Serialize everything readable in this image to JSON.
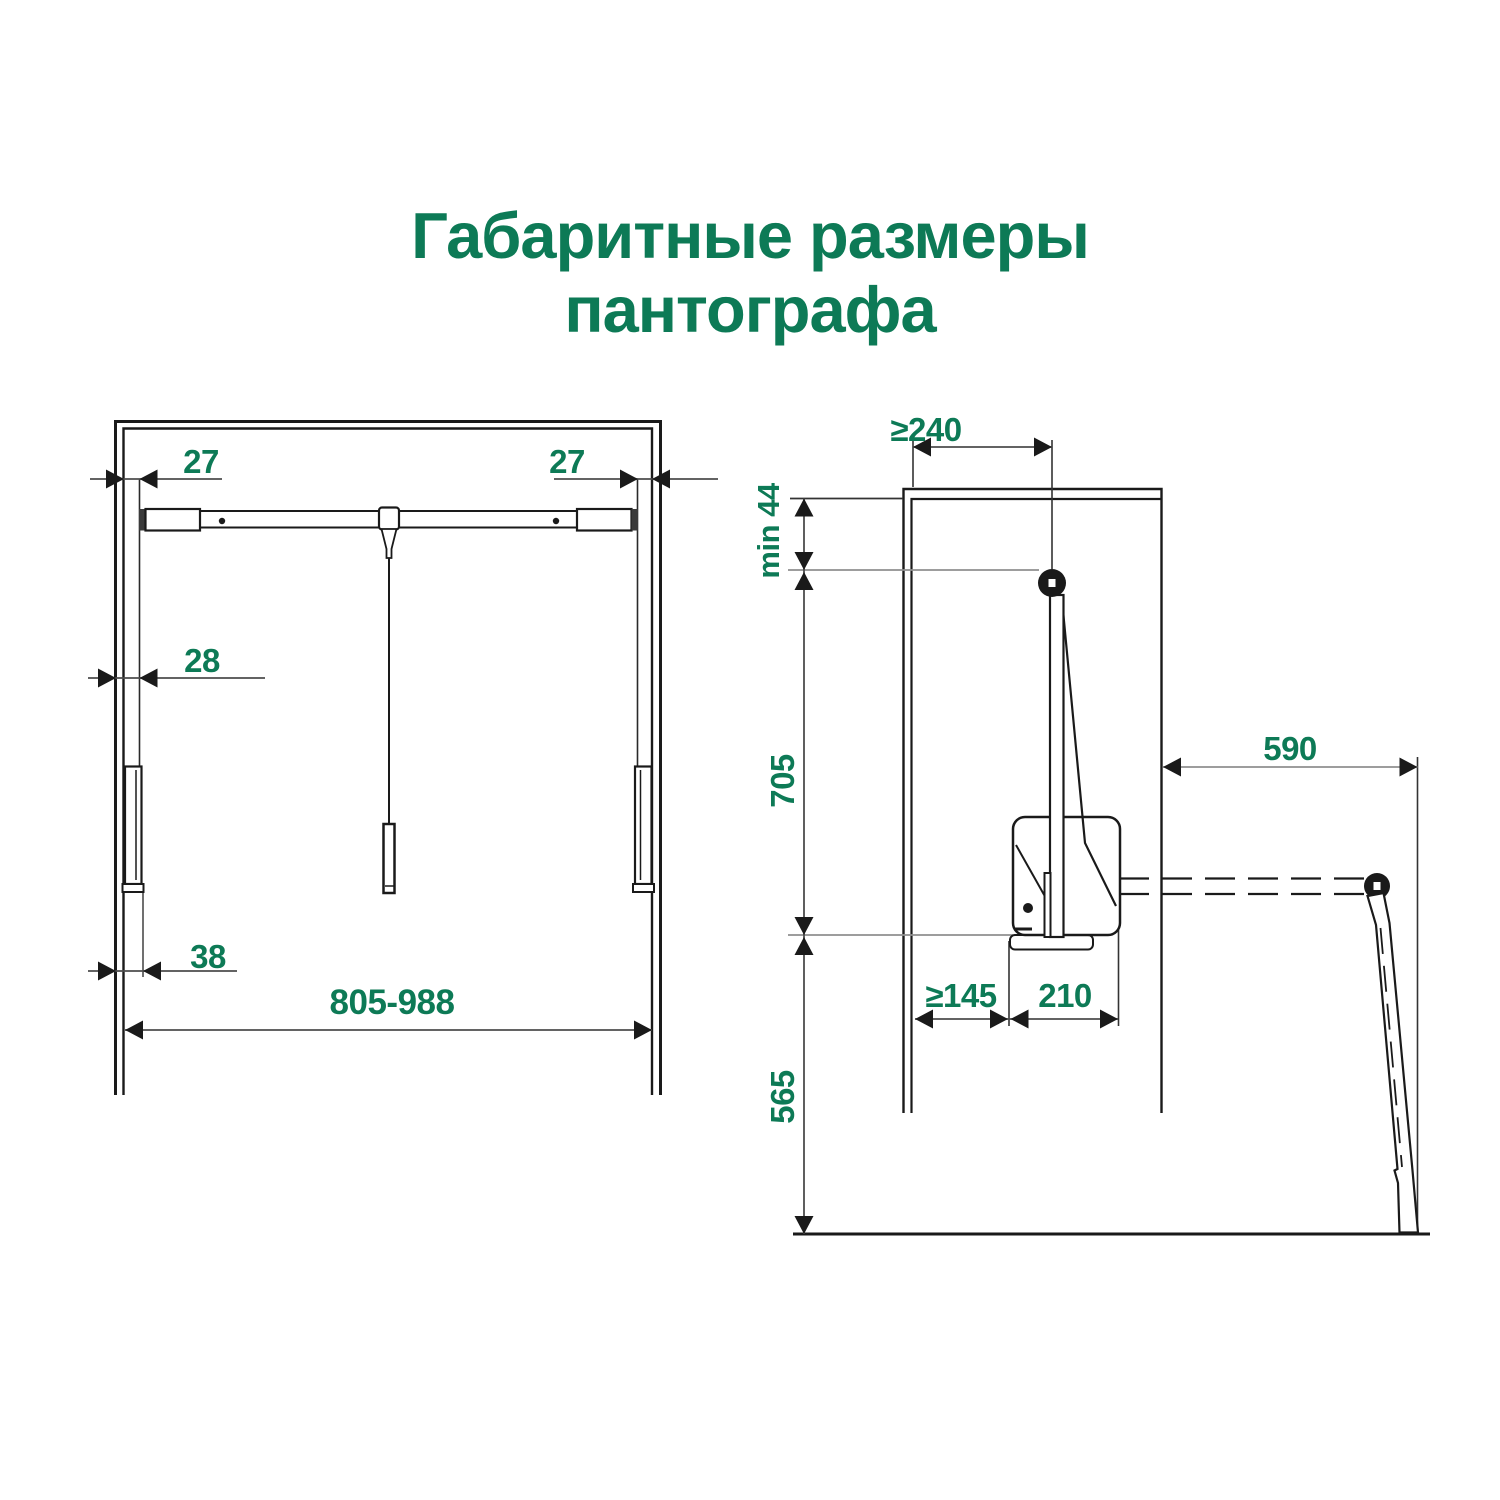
{
  "title": {
    "line1": "Габаритные размеры",
    "line2": "пантографа"
  },
  "front_view": {
    "dim_side_gap_left": "27",
    "dim_side_gap_right": "27",
    "dim_bracket_offset": "28",
    "dim_mount_depth": "38",
    "dim_width_range": "805-988"
  },
  "side_view": {
    "dim_min_top_depth": "≥240",
    "dim_top_clearance": "min 44",
    "dim_upper_height": "705",
    "dim_extension_reach": "590",
    "dim_back_clearance": "≥145",
    "dim_body_length": "210",
    "dim_lower_height": "565"
  },
  "colors": {
    "accent_green": "#0D7A56",
    "line_black": "#1a1a1a",
    "dim_line": "#4d4d4d",
    "ext_line_gray": "#8f8f8f",
    "background": "#ffffff"
  }
}
